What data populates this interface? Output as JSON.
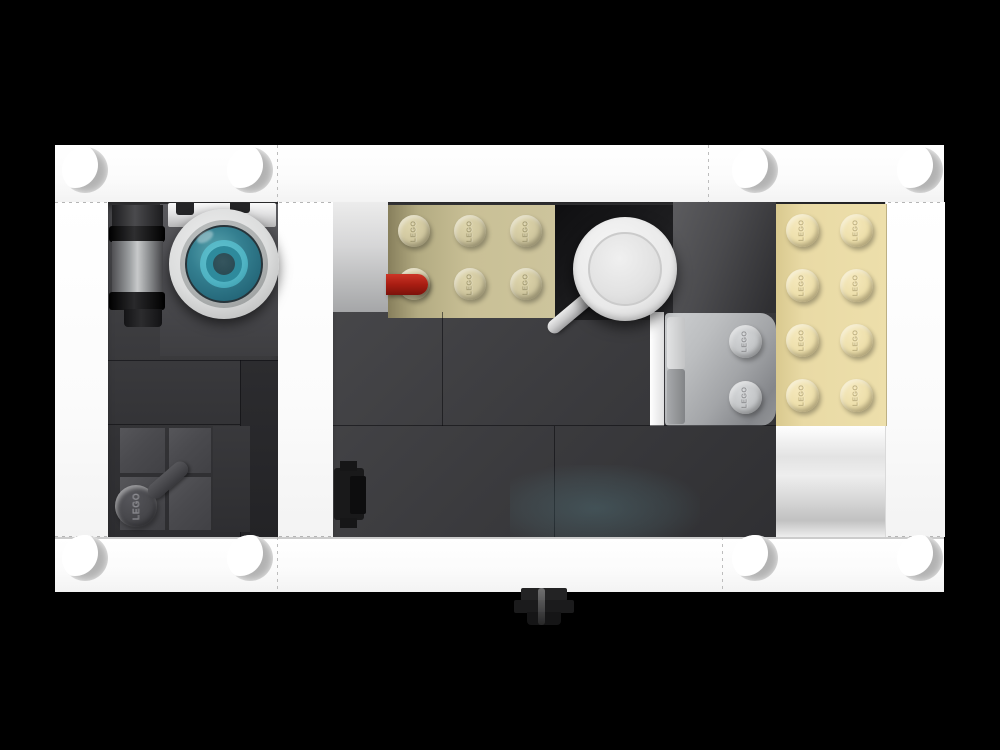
{
  "scene": {
    "title": "Top-down render of a LEGO case build on black background",
    "background_color": "#000000",
    "stud_logo_text": "LEGO"
  },
  "colors": {
    "background": "#000000",
    "frame_white": "#fdfdfd",
    "dark_gray_tile": "#3c3c3e",
    "black_tile": "#1d1d1f",
    "light_gray_panel": "#d8d8d9",
    "middle_tan_plate": "#c8bf96",
    "right_tan_plate": "#ead9a4",
    "bluish_gray_plate": "#b4b6b8",
    "red_bar": "#a81d12",
    "teal_lens": "#3ba4b5",
    "magnifier_silver": "#ededed",
    "barrel_gray": "#9b9da0",
    "black_connector": "#161616"
  },
  "pieces": [
    "white border plates with anti-stud recesses",
    "gray cylinder barrel piece",
    "white round piece with teal lens rings",
    "dark gray tool bar with stud",
    "tan 2x3 plate with LEGO studs",
    "red bar piece",
    "black 2x2 tile",
    "white magnifying glass",
    "light bluish gray 2x2 plate with two studs",
    "tan 2x4 plate with LEGO studs",
    "black clip connector",
    "black round knob below frame"
  ],
  "stud_groups": [
    {
      "name": "middle-tan-plate-stud",
      "d": 32,
      "fill": "radial-gradient(circle at 38% 32%, #ded5ac 0%, #cfc69e 55%, #b3aa80 100%)",
      "text_color": "rgba(100,90,45,0.45)",
      "positions": [
        [
          414,
          231
        ],
        [
          470,
          231
        ],
        [
          526,
          231
        ],
        [
          414,
          284
        ],
        [
          470,
          284
        ],
        [
          526,
          284
        ]
      ]
    },
    {
      "name": "right-tan-plate-stud",
      "d": 33,
      "fill": "radial-gradient(circle at 38% 32%, #f5e8bb 0%, #eddfab 55%, #d6c48c 100%)",
      "text_color": "rgba(130,112,58,0.45)",
      "positions": [
        [
          802,
          230
        ],
        [
          856,
          230
        ],
        [
          802,
          285
        ],
        [
          856,
          285
        ],
        [
          802,
          340
        ],
        [
          856,
          340
        ],
        [
          802,
          395
        ],
        [
          856,
          395
        ]
      ]
    },
    {
      "name": "gray-plate-stud",
      "d": 33,
      "fill": "radial-gradient(circle at 38% 32%, #d4d6d8 0%, #c3c5c7 55%, #a6a8ab 100%)",
      "text_color": "rgba(80,80,84,0.5)",
      "positions": [
        [
          745,
          341
        ],
        [
          745,
          397
        ]
      ]
    },
    {
      "name": "dark-tool-stud",
      "d": 42,
      "fill": "radial-gradient(circle at 38% 32%, #55555a 0%, #47474b 55%, #35353a 100%)",
      "text_color": "rgba(180,180,188,0.3)",
      "positions": [
        [
          136,
          506
        ]
      ]
    }
  ],
  "antistuds": {
    "d": 46,
    "rows_y": [
      170,
      558
    ],
    "xs": [
      85,
      250,
      755,
      920
    ]
  }
}
